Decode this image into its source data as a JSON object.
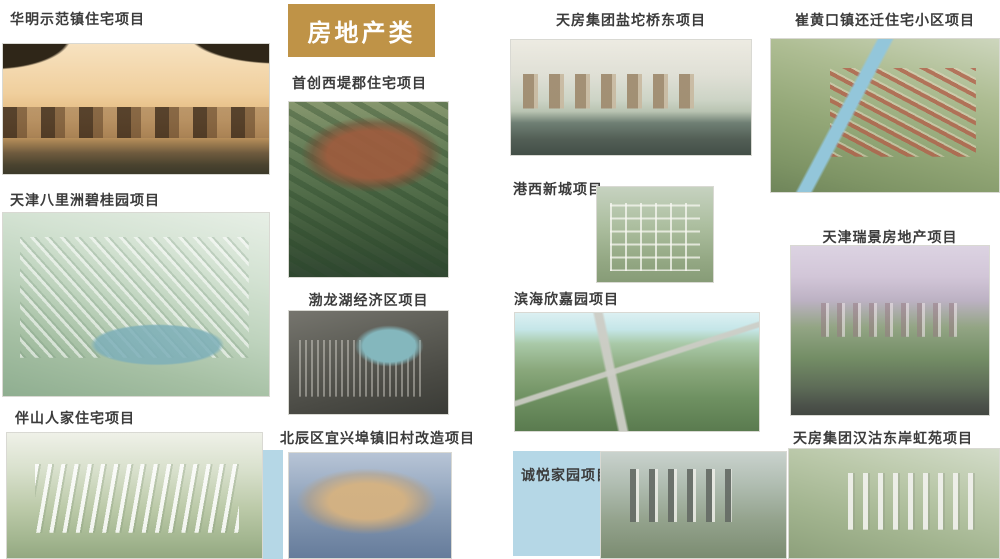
{
  "banner": {
    "label": "房地产类",
    "background_color": "#bf9347",
    "text_color": "#ffffff"
  },
  "accent": {
    "panel_blue": "#b5d7e6",
    "label_text_color": "#3b3b3b"
  },
  "projects": {
    "huaming": {
      "label": "华明示范镇住宅项目",
      "photo": "sepia rendering of European-style townhouses framed by dark trees"
    },
    "balizhou": {
      "label": "天津八里洲碧桂园项目",
      "photo": "soft green aerial rendering of large residential district with waterway"
    },
    "banshan": {
      "label": "伴山人家住宅项目",
      "photo": "aerial rendering of white residential rows amid green fields"
    },
    "shouchuang": {
      "label": "首创西堤郡住宅项目",
      "photo": "red-brick villas with dark roofs set in a lush garden"
    },
    "bolonghu": {
      "label": "渤龙湖经济区项目",
      "photo": "dark aerial masterplan with central teal lake"
    },
    "beichen": {
      "label": "北辰区宜兴埠镇旧村改造项目",
      "photo": "aerial of warm-toned housing estate under blue-grey haze"
    },
    "yantuo": {
      "label": "天房集团盐坨桥东项目",
      "photo": "aerial of high-rise tower slabs along a dark riverfront"
    },
    "gangxi": {
      "label": "港西新城项目",
      "photo": "top-down masterplan grid of a new town in greenery"
    },
    "binhai": {
      "label": "滨海欣嘉园项目",
      "photo": "wide aerial of green district crossed by grey highways, pale cyan sky"
    },
    "chengyue": {
      "label": "诚悦家园项目",
      "photo": "aerial of high-rise towers and low-rise homes in grey-green tones"
    },
    "cuihuangkou": {
      "label": "崔黄口镇还迁住宅小区项目",
      "photo": "aerial of red-roofed housing rows along a diagonal blue canal"
    },
    "ruijing": {
      "label": "天津瑞景房地产项目",
      "photo": "garden community rendering under pink-lavender sky with road in front"
    },
    "hangu": {
      "label": "天房集团汉沽东岸虹苑项目",
      "photo": "aerial of white residential towers in green landscape"
    }
  }
}
